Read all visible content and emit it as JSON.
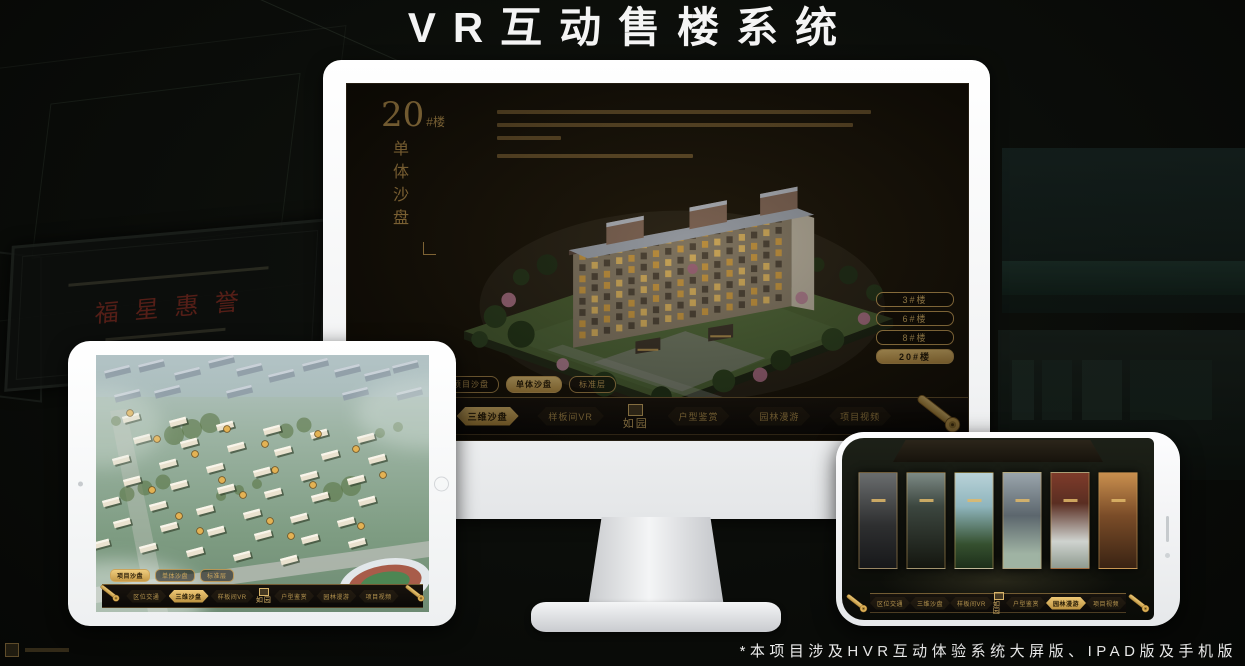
{
  "poster": {
    "title": "VR互动售楼系统",
    "footnote": "*本项目涉及HVR互动体验系统大屏版、IPAD版及手机版"
  },
  "background": {
    "plaque_text": "福星惠誉"
  },
  "colors": {
    "gold": "#c9a158",
    "gold_bright": "#eec876",
    "screen_bg": "#171208"
  },
  "desktop": {
    "headline": {
      "number": "20",
      "suffix": "#楼",
      "subtitle": "单体沙盘"
    },
    "floor_buttons": [
      {
        "label": "3#楼",
        "active": false
      },
      {
        "label": "6#楼",
        "active": false
      },
      {
        "label": "8#楼",
        "active": false
      },
      {
        "label": "20#楼",
        "active": true
      }
    ],
    "sub_tabs": [
      {
        "label": "项目沙盘",
        "active": false
      },
      {
        "label": "单体沙盘",
        "active": true
      },
      {
        "label": "标准层",
        "active": false
      }
    ],
    "nav": {
      "left": [
        {
          "label": "区位交通",
          "active": false
        },
        {
          "label": "三维沙盘",
          "active": true
        },
        {
          "label": "样板间VR",
          "active": false
        }
      ],
      "logo": "如园",
      "right": [
        {
          "label": "户型鉴赏",
          "active": false
        },
        {
          "label": "园林漫游",
          "active": false
        },
        {
          "label": "项目视频",
          "active": false
        }
      ]
    }
  },
  "tablet": {
    "sub_tabs": [
      {
        "label": "项目沙盘",
        "active": true
      },
      {
        "label": "单体沙盘",
        "active": false
      },
      {
        "label": "标准层",
        "active": false
      }
    ],
    "nav": {
      "left": [
        {
          "label": "区位交通",
          "active": false
        },
        {
          "label": "三维沙盘",
          "active": true
        },
        {
          "label": "样板间VR",
          "active": false
        }
      ],
      "logo": "如园",
      "right": [
        {
          "label": "户型鉴赏",
          "active": false
        },
        {
          "label": "园林漫游",
          "active": false
        },
        {
          "label": "项目视频",
          "active": false
        }
      ]
    }
  },
  "phone": {
    "nav": {
      "left": [
        {
          "label": "区位交通",
          "active": false
        },
        {
          "label": "三维沙盘",
          "active": false
        },
        {
          "label": "样板间VR",
          "active": false
        }
      ],
      "logo": "如园",
      "right": [
        {
          "label": "户型鉴赏",
          "active": false
        },
        {
          "label": "园林漫游",
          "active": true
        },
        {
          "label": "项目视频",
          "active": false
        }
      ]
    }
  }
}
